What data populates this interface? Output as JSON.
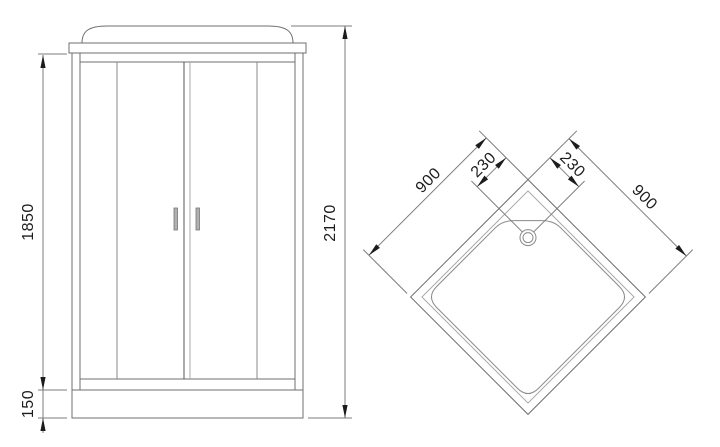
{
  "front": {
    "dims": {
      "door_height": "1850",
      "tray_height": "150",
      "total_height": "2170"
    }
  },
  "top": {
    "dims": {
      "side_left": "900",
      "side_right": "900",
      "drain_offset_left": "230",
      "drain_offset_right": "230"
    }
  },
  "colors": {
    "line": "#6f6f6f",
    "line_medium": "#8a8a8a",
    "line_dark": "#555555",
    "line_light": "#a8a8a8",
    "dim": "#7d7d7d",
    "text": "#1c1c1c",
    "arrow": "#1c1c1c",
    "handle_fill": "#b0b0b0",
    "bg": "#ffffff"
  }
}
